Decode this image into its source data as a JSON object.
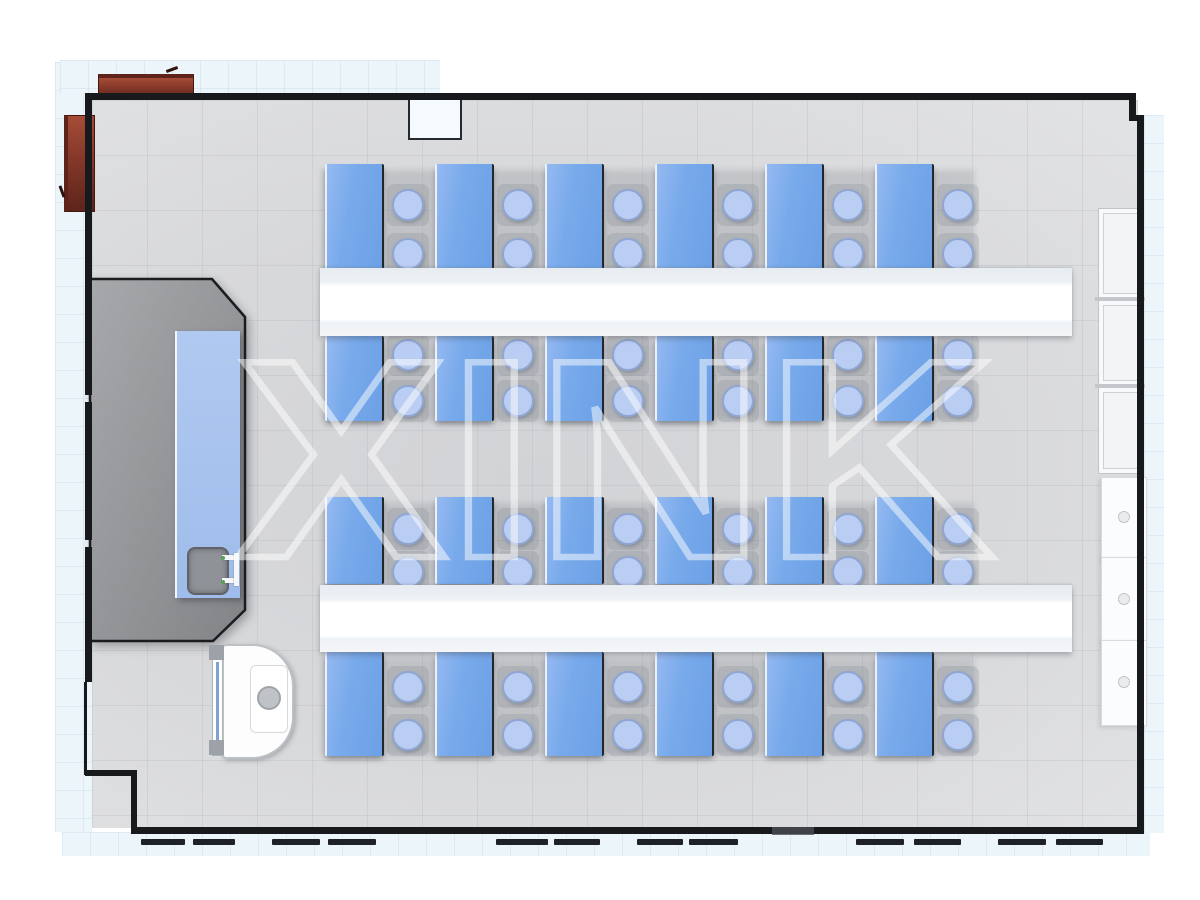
{
  "watermark": {
    "text": "XINK",
    "color": "#FFFFFF",
    "opacity": 0.5
  },
  "palette": {
    "wall": "#17191C",
    "floor": "#D8D9DB",
    "exterior_tile": "#ECF5FA",
    "desk_blue": "#74A7EA",
    "stool_blue": "#BACDF3",
    "bench_white": "#FFFFFF",
    "platform_gray": "#97989B",
    "teacher_desk_blue": "#A8C3EE",
    "cabinet_brown": "#7E3427",
    "cabinet_white": "#FBFCFD"
  },
  "counts": {
    "student_desks": 24,
    "stools": 48,
    "benches": 2,
    "wall_cabinets": 6
  },
  "layout": {
    "desk_columns_x": [
      325,
      435,
      545,
      655,
      765,
      875
    ],
    "desk_width": 55,
    "stool_offset_x": 83,
    "rows": [
      {
        "desk_top": 164,
        "desk_height": 109,
        "stool_cy": [
          205,
          254
        ]
      },
      {
        "desk_top": 336,
        "desk_height": 85,
        "stool_cy": [
          355,
          401
        ]
      },
      {
        "desk_top": 497,
        "desk_height": 87,
        "stool_cy": [
          529,
          572
        ]
      },
      {
        "desk_top": 652,
        "desk_height": 104,
        "stool_cy": [
          687,
          735
        ]
      }
    ],
    "benches": [
      {
        "x": 320,
        "y": 268,
        "w": 752,
        "h": 68
      },
      {
        "x": 320,
        "y": 585,
        "w": 752,
        "h": 67
      }
    ],
    "framed_cabinets": [
      {
        "x": 1098,
        "y": 208,
        "w": 44,
        "h": 89
      },
      {
        "x": 1098,
        "y": 300,
        "w": 44,
        "h": 84
      },
      {
        "x": 1098,
        "y": 387,
        "w": 44,
        "h": 85
      }
    ],
    "plain_cabinets": [
      {
        "x": 1101,
        "y": 477,
        "w": 44,
        "h": 80,
        "knob_cy": 517
      },
      {
        "x": 1101,
        "y": 557,
        "w": 44,
        "h": 83,
        "knob_cy": 599
      },
      {
        "x": 1101,
        "y": 640,
        "w": 44,
        "h": 84,
        "knob_cy": 682
      }
    ],
    "window_dashes": [
      [
        141,
        44
      ],
      [
        193,
        42
      ],
      [
        272,
        48
      ],
      [
        328,
        48
      ],
      [
        496,
        52
      ],
      [
        554,
        46
      ],
      [
        637,
        46
      ],
      [
        689,
        49
      ],
      [
        856,
        48
      ],
      [
        914,
        47
      ],
      [
        998,
        48
      ],
      [
        1056,
        47
      ]
    ]
  }
}
